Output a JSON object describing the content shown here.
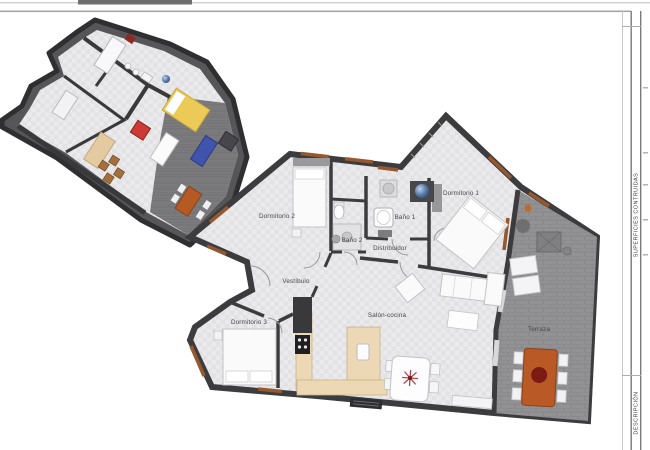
{
  "sidebar": {
    "superficies_label": "SUPERFICIES CONTRUIDAS",
    "descripcion_label": "DESCRIPCIÓN"
  },
  "plan2d": {
    "rooms": [
      {
        "label": "Dormitorio 1"
      },
      {
        "label": "Dormitorio 2"
      },
      {
        "label": "Dormitorio 3"
      },
      {
        "label": "Baño 1"
      },
      {
        "label": "Baño 2"
      },
      {
        "label": "Distribuidor"
      },
      {
        "label": "Vestíbulo"
      },
      {
        "label": "Salón-cocina"
      },
      {
        "label": "Terraza"
      }
    ],
    "colors": {
      "wall": "#3c3c3e",
      "floor": "#eaeaec",
      "terrace": "#929294",
      "kitchen": "#ecd8b4",
      "window_sill": "#96582e",
      "table_orange": "#b95a26",
      "flower_red": "#b03a4a",
      "shower_blue": "#5b7fae"
    }
  },
  "plan3d": {
    "colors": {
      "wall": "#3a3a3c",
      "terrace_floor": "#7b7b7e",
      "bed_yellow": "#ecca57",
      "chair_red": "#cb3a35",
      "sofa_blue": "#4053ad",
      "table_orange": "#b45a22",
      "desk_tan": "#e4caa0"
    }
  }
}
